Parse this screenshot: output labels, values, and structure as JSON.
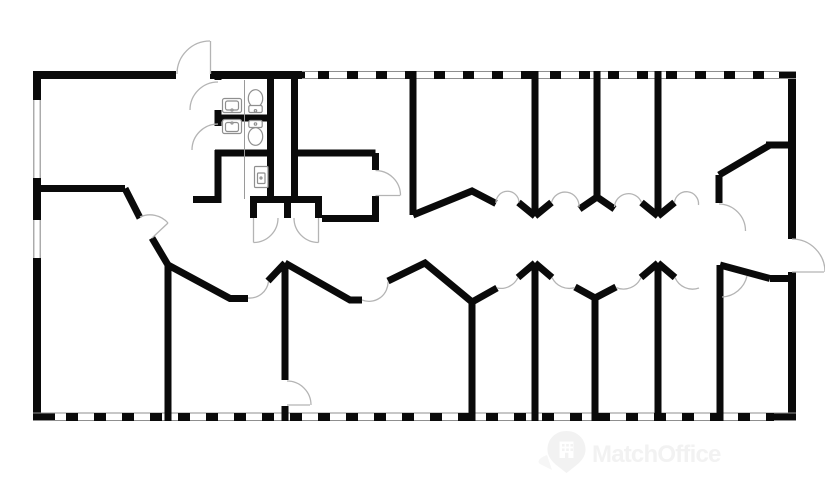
{
  "watermark": {
    "brand": "MatchOffice",
    "logo": "map-pin-building-icon"
  },
  "palette": {
    "background": "#ffffff",
    "wall": "#0a0a0a",
    "window_line": "#8f8f8f",
    "door_arc": "#b4b4b4",
    "fixture_line": "#8f8f8f",
    "watermark_gray": "#f2f2f2"
  },
  "floorplan": {
    "type": "office-floor-plan",
    "orientation": "landscape",
    "corridor": "central horizontal corridor with rooms on both sides",
    "exterior_windows": [
      "top",
      "bottom",
      "left"
    ],
    "exterior_doors": [
      "top-left-outswing",
      "right-middle-outswing"
    ],
    "rooms_top_count": 6,
    "rooms_bottom_count": 7,
    "wc_count": 2,
    "fixtures": [
      {
        "type": "washbasin",
        "room": "wc-1"
      },
      {
        "type": "toilet",
        "room": "wc-1"
      },
      {
        "type": "washbasin",
        "room": "wc-2"
      },
      {
        "type": "toilet",
        "room": "wc-2"
      },
      {
        "type": "water-heater",
        "room": "utility-closet"
      }
    ]
  }
}
